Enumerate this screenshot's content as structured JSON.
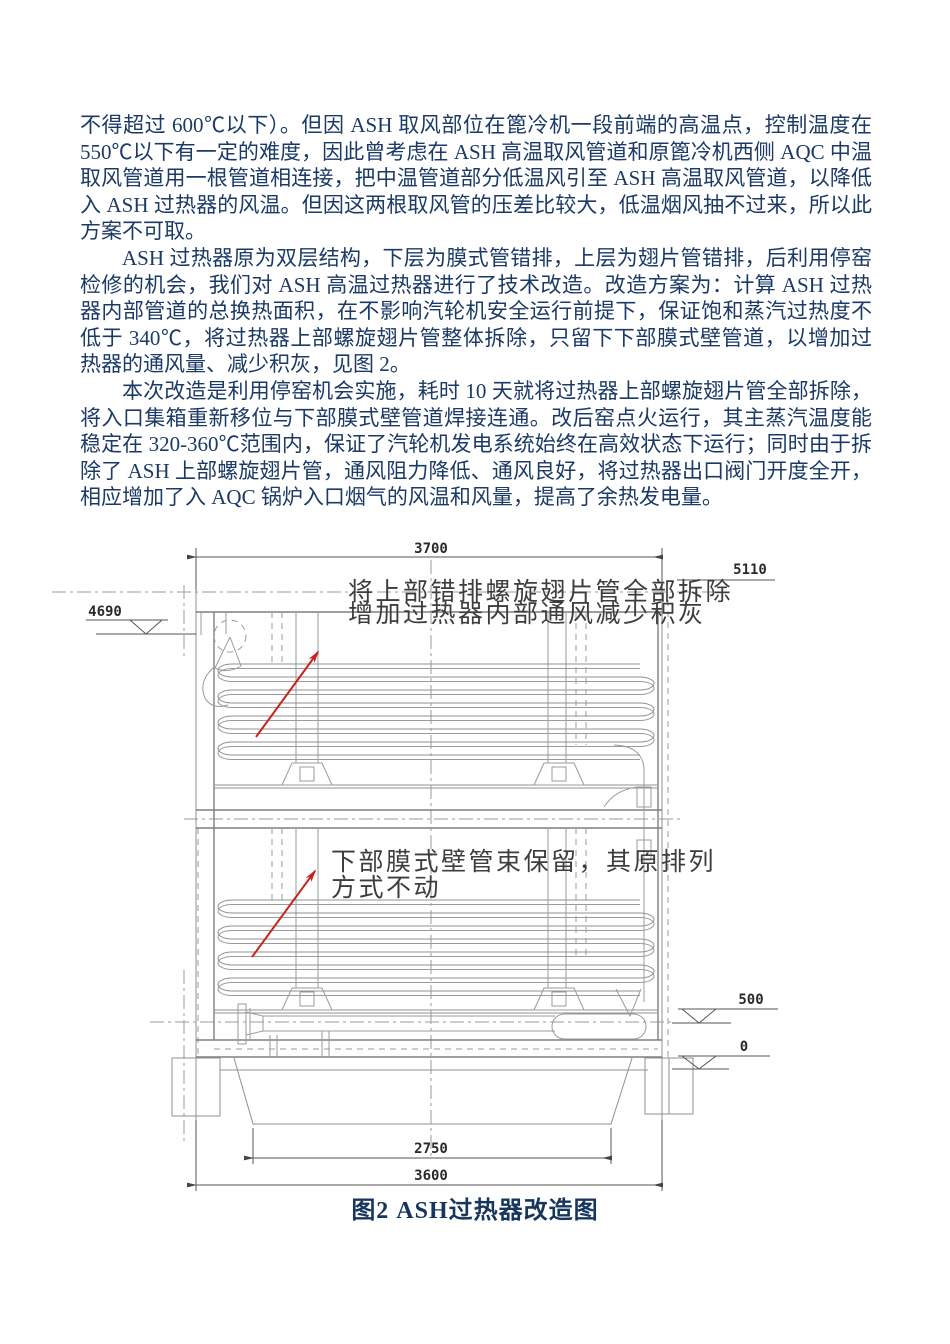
{
  "article": {
    "text_color": "#1b3a66",
    "paragraphs": [
      "不得超过 600℃以下）。但因 ASH 取风部位在篦冷机一段前端的高温点，控制温度在 550℃以下有一定的难度，因此曾考虑在 ASH 高温取风管道和原篦冷机西侧 AQC 中温取风管道用一根管道相连接，把中温管道部分低温风引至 ASH 高温取风管道，以降低入 ASH 过热器的风温。但因这两根取风管的压差比较大，低温烟风抽不过来，所以此方案不可取。",
      "ASH 过热器原为双层结构，下层为膜式管错排，上层为翅片管错排，后利用停窑检修的机会，我们对 ASH 高温过热器进行了技术改造。改造方案为：计算 ASH 过热器内部管道的总换热面积，在不影响汽轮机安全运行前提下，保证饱和蒸汽过热度不低于 340℃，将过热器上部螺旋翅片管整体拆除，只留下下部膜式壁管道，以增加过热器的通风量、减少积灰，见图 2。",
      "本次改造是利用停窑机会实施，耗时 10 天就将过热器上部螺旋翅片管全部拆除，将入口集箱重新移位与下部膜式壁管道焊接连通。改后窑点火运行，其主蒸汽温度能稳定在 320-360℃范围内，保证了汽轮机发电系统始终在高效状态下运行；同时由于拆除了 ASH 上部螺旋翅片管，通风阻力降低、通风良好，将过热器出口阀门开度全开，相应增加了入 AQC 锅炉入口烟气的风温和风量，提高了余热发电量。"
    ]
  },
  "figure": {
    "caption": "图2  ASH过热器改造图",
    "caption_color": "#17365D",
    "line_color": "#8f9191",
    "arrow_color": "#c9241c",
    "annotations": {
      "upper_line1": "将上部错排螺旋翅片管全部拆除",
      "upper_line2": "增加过热器内部通风减少积灰",
      "lower_line1": "下部膜式壁管束保留，其原排列",
      "lower_line2": "方式不动"
    },
    "dimensions": {
      "width_top": "3700",
      "elev_top": "5110",
      "elev_outlet": "4690",
      "elev_mid": "500",
      "elev_zero": "0",
      "width_hopper": "2750",
      "width_base": "3600"
    }
  }
}
